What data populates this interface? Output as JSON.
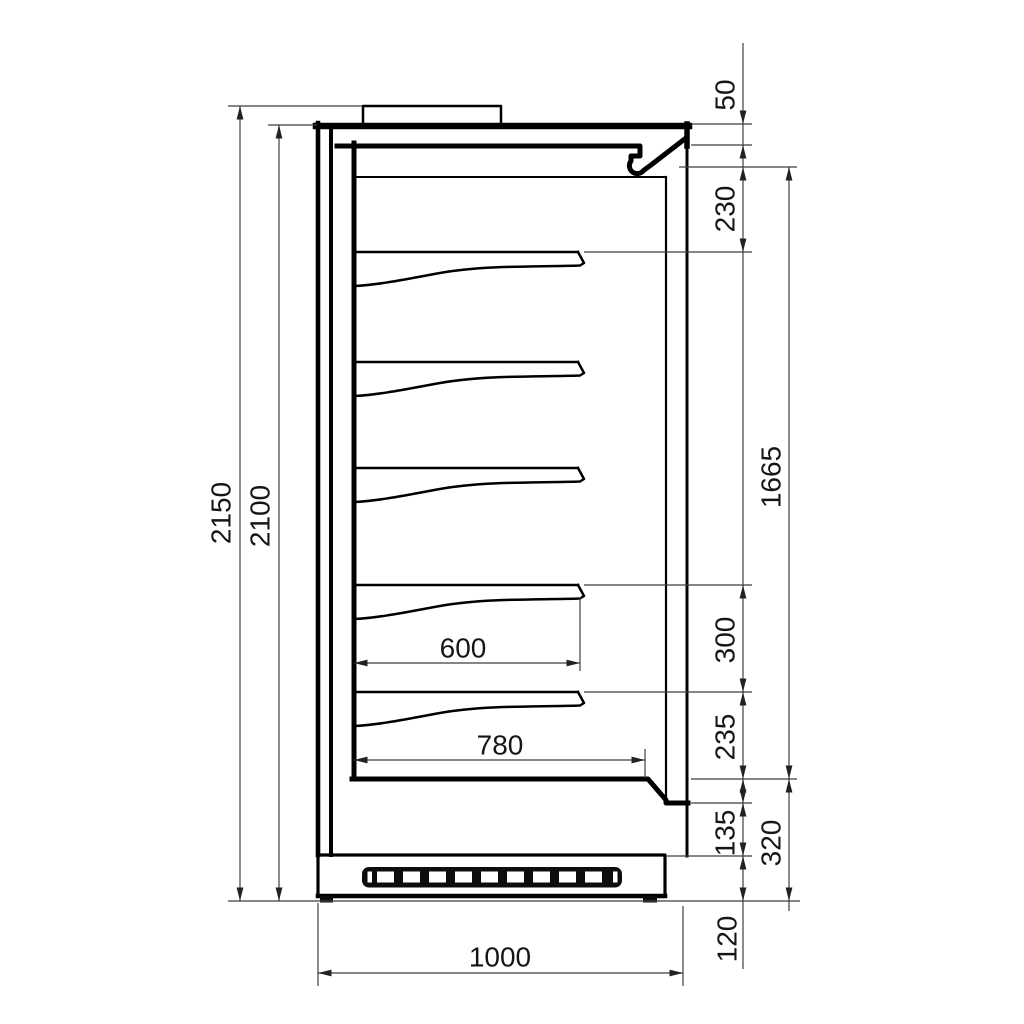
{
  "colors": {
    "background": "#ffffff",
    "outline": "#000000",
    "dimension": "#3f3f3f",
    "label": "#161616",
    "grille": "#0d0d0d"
  },
  "drawing": {
    "type": "refrigerated-multideck-side-section",
    "dimensions_mm": {
      "overall_height": "2150",
      "body_height": "2100",
      "canopy_front_height": "50",
      "top_section_height": "230",
      "display_opening_height": "1665",
      "shelf_pitch": "300",
      "lowest_shelf_clearance": "235",
      "front_panel_height": "135",
      "base_section_height": "320",
      "plinth_height": "120",
      "shelf_depth": "600",
      "interior_depth": "780",
      "overall_depth": "1000"
    }
  }
}
